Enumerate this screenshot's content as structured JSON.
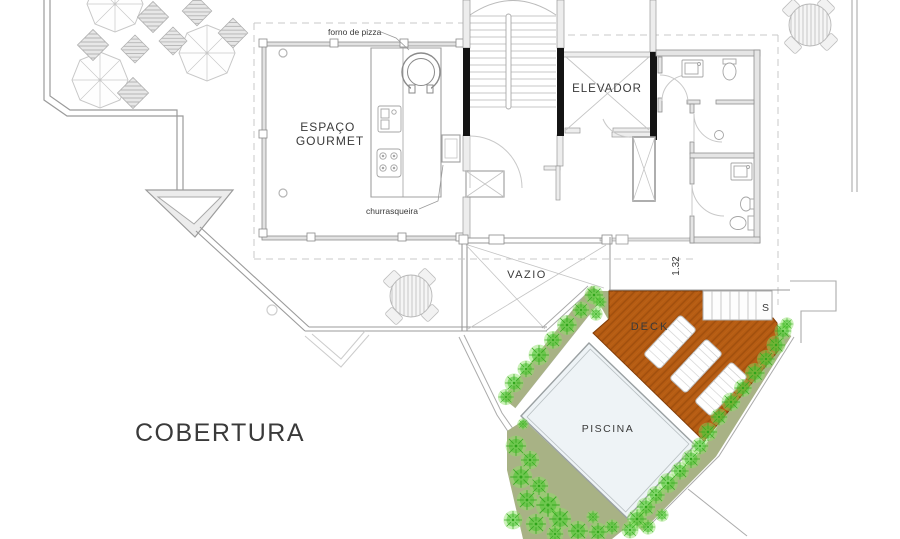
{
  "title": "COBERTURA",
  "rooms": {
    "espaco_gourmet_line1": "ESPAÇO",
    "espaco_gourmet_line2": "GOURMET",
    "elevador": "ELEVADOR",
    "vazio": "VAZIO",
    "deck": "DECK",
    "piscina": "PISCINA"
  },
  "annotations": {
    "forno_de_pizza": "forno de pizza",
    "churrasqueira": "churrasqueira",
    "stair_direction": "S",
    "void_dimension": "1.32"
  },
  "colors": {
    "deck": "#b65c13",
    "deck_hatch": "#8f4509",
    "planter": "#a8b285",
    "bush": "#49c62e",
    "pool": "#eef3f6",
    "wall": "#8f8f8f",
    "structure": "#141414",
    "text": "#3a3a3a"
  }
}
